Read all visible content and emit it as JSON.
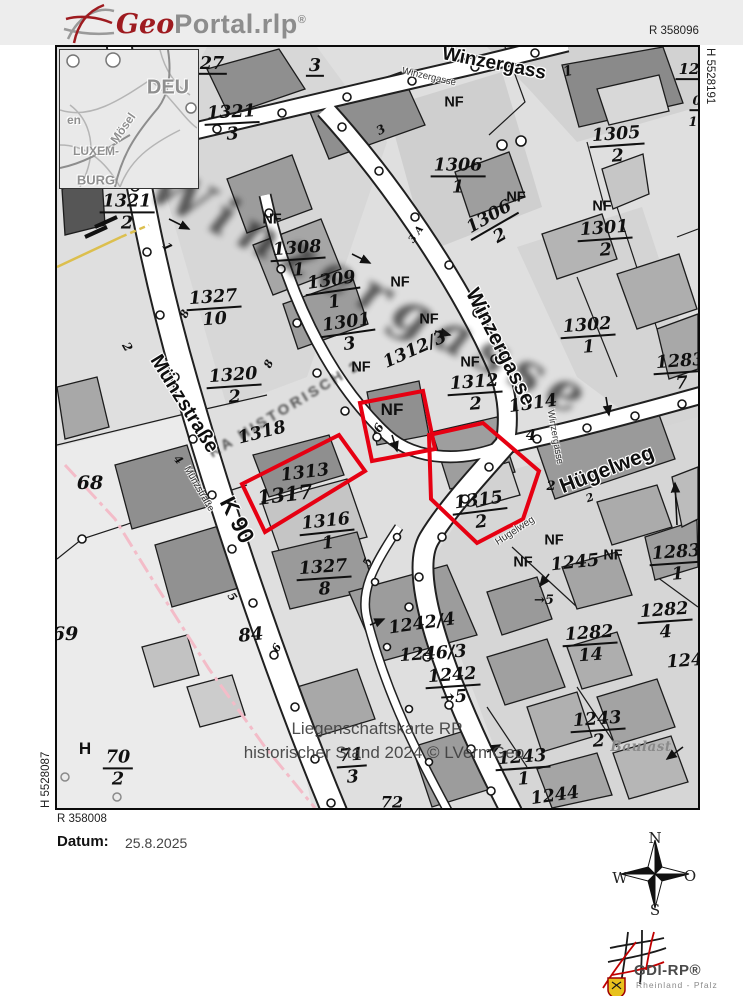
{
  "colors": {
    "highlight": "#e60012",
    "pink_boundary": "#f3bcc8",
    "yellow_line": "#dcbf4e"
  },
  "header": {
    "logo_geo": "Geo",
    "logo_rest": "Portal.rlp",
    "logo_reg": "®"
  },
  "frame": {
    "r_top": "R 358096",
    "h_right": "H 5528191",
    "h_left": "H 5528087",
    "r_bottom": "R 358008"
  },
  "watermark": {
    "line1": "Liegenschaftskarte RP",
    "line2": "historischer Stand 2024 © LVermGeo",
    "big_street": "Winzergasse",
    "diag": "KA HISTORISCH 2"
  },
  "footer": {
    "date_label": "Datum:",
    "date_value": "25.8.2025",
    "compass": {
      "n": "N",
      "e": "O",
      "s": "S",
      "w": "W"
    },
    "logo": {
      "title": "GDI-RP®",
      "subtitle": "Rheinland - Pfalz"
    }
  },
  "inset_labels": [
    {
      "t": "DEU",
      "x": 108,
      "y": 38,
      "fs": 20,
      "rot": 0
    },
    {
      "t": "en",
      "x": 14,
      "y": 70,
      "fs": 12,
      "rot": 0
    },
    {
      "t": "Mösel",
      "x": 63,
      "y": 78,
      "fs": 12,
      "rot": -55
    },
    {
      "t": "LUXEM-",
      "x": 36,
      "y": 101,
      "fs": 12,
      "rot": 0
    },
    {
      "t": "BURG",
      "x": 36,
      "y": 130,
      "fs": 13,
      "rot": 0
    }
  ],
  "map_labels": [
    {
      "t": "27",
      "x": 155,
      "y": 18,
      "ul": 1
    },
    {
      "t": "3",
      "x": 258,
      "y": 20,
      "ul": 1
    },
    {
      "t": "1321",
      "d": "3",
      "x": 175,
      "y": 77,
      "rot": -3
    },
    {
      "t": "1321",
      "d": "2",
      "x": 70,
      "y": 166
    },
    {
      "t": "1",
      "x": 110,
      "y": 200,
      "rot": 55,
      "fs": 12
    },
    {
      "t": "2",
      "x": 70,
      "y": 300,
      "rot": 60,
      "fs": 12
    },
    {
      "t": "NF",
      "x": 215,
      "y": 173,
      "cls": "nf"
    },
    {
      "t": "1308",
      "d": "1",
      "x": 241,
      "y": 213,
      "rot": -4
    },
    {
      "t": "1309",
      "d": "1",
      "x": 276,
      "y": 245,
      "rot": -8
    },
    {
      "t": "NF",
      "x": 343,
      "y": 236,
      "cls": "nf"
    },
    {
      "t": "1301",
      "d": "3",
      "x": 291,
      "y": 287,
      "rot": -8
    },
    {
      "t": "NF",
      "x": 372,
      "y": 273,
      "cls": "nf"
    },
    {
      "t": "1327",
      "d": "10",
      "x": 157,
      "y": 262,
      "rot": -4
    },
    {
      "t": "8",
      "x": 128,
      "y": 267,
      "rot": -65,
      "fs": 11
    },
    {
      "t": "1320",
      "d": "2",
      "x": 177,
      "y": 340,
      "rot": -4
    },
    {
      "t": "8",
      "x": 212,
      "y": 317,
      "rot": -65,
      "fs": 11
    },
    {
      "t": "1318",
      "x": 205,
      "y": 386,
      "rot": -14
    },
    {
      "t": "1312/3",
      "x": 358,
      "y": 303,
      "rot": -24
    },
    {
      "t": "NF",
      "x": 304,
      "y": 321,
      "cls": "nf"
    },
    {
      "t": "NF",
      "x": 413,
      "y": 316,
      "cls": "nf"
    },
    {
      "t": "1312",
      "d": "2",
      "x": 418,
      "y": 347,
      "rot": -4
    },
    {
      "t": "1314",
      "x": 476,
      "y": 357,
      "rot": -8
    },
    {
      "t": "4",
      "x": 474,
      "y": 389,
      "fs": 15
    },
    {
      "t": "NF",
      "x": 335,
      "y": 363,
      "cls": "nf",
      "fs": 17
    },
    {
      "t": "6",
      "x": 322,
      "y": 381,
      "rot": -60,
      "fs": 12
    },
    {
      "t": "1313",
      "x": 248,
      "y": 426,
      "rot": -7
    },
    {
      "t": "1317",
      "x": 228,
      "y": 448,
      "rot": -7,
      "fs": 20
    },
    {
      "t": "1316",
      "d": "1",
      "x": 270,
      "y": 486,
      "rot": -6
    },
    {
      "t": "5",
      "x": 311,
      "y": 515,
      "rot": -65,
      "fs": 11
    },
    {
      "t": "1327",
      "d": "8",
      "x": 267,
      "y": 532,
      "rot": -4
    },
    {
      "t": "1315",
      "d": "2",
      "x": 423,
      "y": 465,
      "rot": -7
    },
    {
      "t": "2",
      "x": 494,
      "y": 440,
      "fs": 13
    },
    {
      "t": "68",
      "x": 33,
      "y": 437,
      "fs": 19
    },
    {
      "t": "69",
      "x": 8,
      "y": 588,
      "fs": 19
    },
    {
      "t": "84",
      "x": 194,
      "y": 589,
      "rot": -6,
      "fs": 18
    },
    {
      "t": "6",
      "x": 220,
      "y": 601,
      "rot": -60,
      "fs": 11
    },
    {
      "t": "4",
      "x": 121,
      "y": 413,
      "rot": 50,
      "fs": 11
    },
    {
      "t": "5",
      "x": 175,
      "y": 550,
      "rot": 55,
      "fs": 11
    },
    {
      "t": "2",
      "x": 533,
      "y": 451,
      "rot": -20,
      "fs": 11
    },
    {
      "t": "NF",
      "x": 497,
      "y": 494,
      "cls": "nf"
    },
    {
      "t": "NF",
      "x": 466,
      "y": 516,
      "cls": "nf"
    },
    {
      "t": "1245",
      "x": 518,
      "y": 516,
      "rot": -6
    },
    {
      "t": "NF",
      "x": 556,
      "y": 509,
      "cls": "nf"
    },
    {
      "t": "1283",
      "d": "1",
      "x": 620,
      "y": 517,
      "rot": -4
    },
    {
      "t": "1282",
      "d": "4",
      "x": 608,
      "y": 575,
      "rot": -4
    },
    {
      "t": "1282",
      "d": "14",
      "x": 533,
      "y": 598,
      "rot": -4
    },
    {
      "t": "1283",
      "d": "7",
      "x": 624,
      "y": 326,
      "rot": -4
    },
    {
      "t": "12",
      "x": 632,
      "y": 24,
      "ul": 1,
      "fs": 15
    },
    {
      "t": "0",
      "x": 640,
      "y": 56,
      "ul": 1,
      "fs": 13
    },
    {
      "t": "1",
      "x": 636,
      "y": 76,
      "fs": 13
    },
    {
      "t": "1",
      "x": 511,
      "y": 25,
      "rot": -12,
      "fs": 14
    },
    {
      "t": "3",
      "x": 324,
      "y": 83,
      "rot": -30,
      "fs": 12
    },
    {
      "t": "1306",
      "d": "1",
      "x": 401,
      "y": 130
    },
    {
      "t": "1305",
      "d": "2",
      "x": 560,
      "y": 99,
      "rot": -4
    },
    {
      "t": "1306",
      "d": "2",
      "x": 438,
      "y": 180,
      "rot": -30
    },
    {
      "t": "3 A",
      "x": 360,
      "y": 188,
      "rot": -55,
      "fs": 10
    },
    {
      "t": "NF",
      "x": 397,
      "y": 56,
      "cls": "nf"
    },
    {
      "t": "NF",
      "x": 459,
      "y": 151,
      "cls": "nf"
    },
    {
      "t": "NF",
      "x": 545,
      "y": 160,
      "cls": "nf"
    },
    {
      "t": "1301",
      "d": "2",
      "x": 548,
      "y": 193,
      "rot": -4
    },
    {
      "t": "1302",
      "d": "1",
      "x": 531,
      "y": 290,
      "rot": -4
    },
    {
      "t": "1242/4",
      "x": 365,
      "y": 577,
      "rot": -8
    },
    {
      "t": "1246/3",
      "x": 376,
      "y": 607,
      "rot": -4
    },
    {
      "t": "1242",
      "d": "→5",
      "x": 396,
      "y": 640,
      "rot": -4
    },
    {
      "t": "→5",
      "x": 487,
      "y": 554,
      "fs": 13
    },
    {
      "t": "71",
      "d": "3",
      "x": 295,
      "y": 720,
      "rot": -4
    },
    {
      "t": "72",
      "x": 335,
      "y": 756,
      "fs": 16
    },
    {
      "t": "H",
      "x": 28,
      "y": 702,
      "cls": "nf",
      "fs": 17
    },
    {
      "t": "70",
      "d": "2",
      "x": 61,
      "y": 722
    },
    {
      "t": "1243",
      "d": "2",
      "x": 541,
      "y": 684,
      "rot": -4
    },
    {
      "t": "Baulast",
      "x": 584,
      "y": 700,
      "cls": "gray"
    },
    {
      "t": "1243",
      "d": "1",
      "x": 466,
      "y": 722,
      "rot": -4
    },
    {
      "t": "1244",
      "x": 498,
      "y": 749,
      "rot": -8
    },
    {
      "t": "1243",
      "x": 634,
      "y": 614,
      "rot": -4
    },
    {
      "t": "Winzergass",
      "x": 437,
      "y": 17,
      "rot": 11,
      "cls": "street",
      "fs": 19
    },
    {
      "t": "Winzergasse",
      "x": 372,
      "y": 30,
      "rot": 13,
      "cls": "street-sm"
    },
    {
      "t": "Winzergasse",
      "x": 443,
      "y": 300,
      "rot": 63,
      "cls": "street",
      "fs": 21
    },
    {
      "t": "Winzergasse",
      "x": 498,
      "y": 390,
      "rot": 80,
      "cls": "street-sm"
    },
    {
      "t": "Münzstraße",
      "x": 127,
      "y": 357,
      "rot": 58,
      "cls": "street",
      "fs": 20
    },
    {
      "t": "Münzstraße",
      "x": 142,
      "y": 442,
      "rot": 60,
      "cls": "street-sm"
    },
    {
      "t": "K 90",
      "x": 180,
      "y": 473,
      "rot": 63,
      "cls": "street",
      "fs": 23
    },
    {
      "t": "Hügelweg",
      "x": 550,
      "y": 423,
      "rot": -21,
      "cls": "street",
      "fs": 21
    },
    {
      "t": "Hugelweg",
      "x": 458,
      "y": 484,
      "rot": -33,
      "cls": "street-sm",
      "fs": 10
    }
  ]
}
